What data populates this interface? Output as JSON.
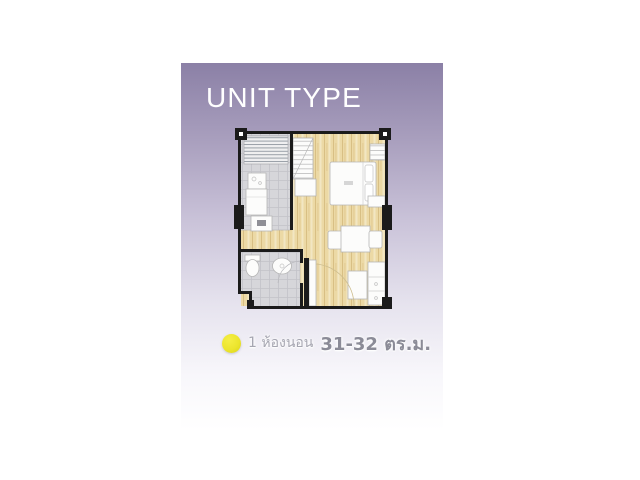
{
  "header": {
    "title": "UNIT TYPE"
  },
  "legend": {
    "bullet_color": "#ece52d",
    "bedrooms": "1 ห้องนอน",
    "area": "31-32 ตร.ม."
  },
  "panel": {
    "gradient_top_color": "#8b80a6",
    "gradient_bottom_color": "#ffffff"
  },
  "floor_plan": {
    "rooms": [
      "kitchen",
      "bedroom",
      "bathroom",
      "living-dining",
      "entrance-hall"
    ],
    "wall_color": "#1b1b1b",
    "wood_floor_color": "#ecd9a5",
    "tile_floor_color": "#d6d6da"
  }
}
